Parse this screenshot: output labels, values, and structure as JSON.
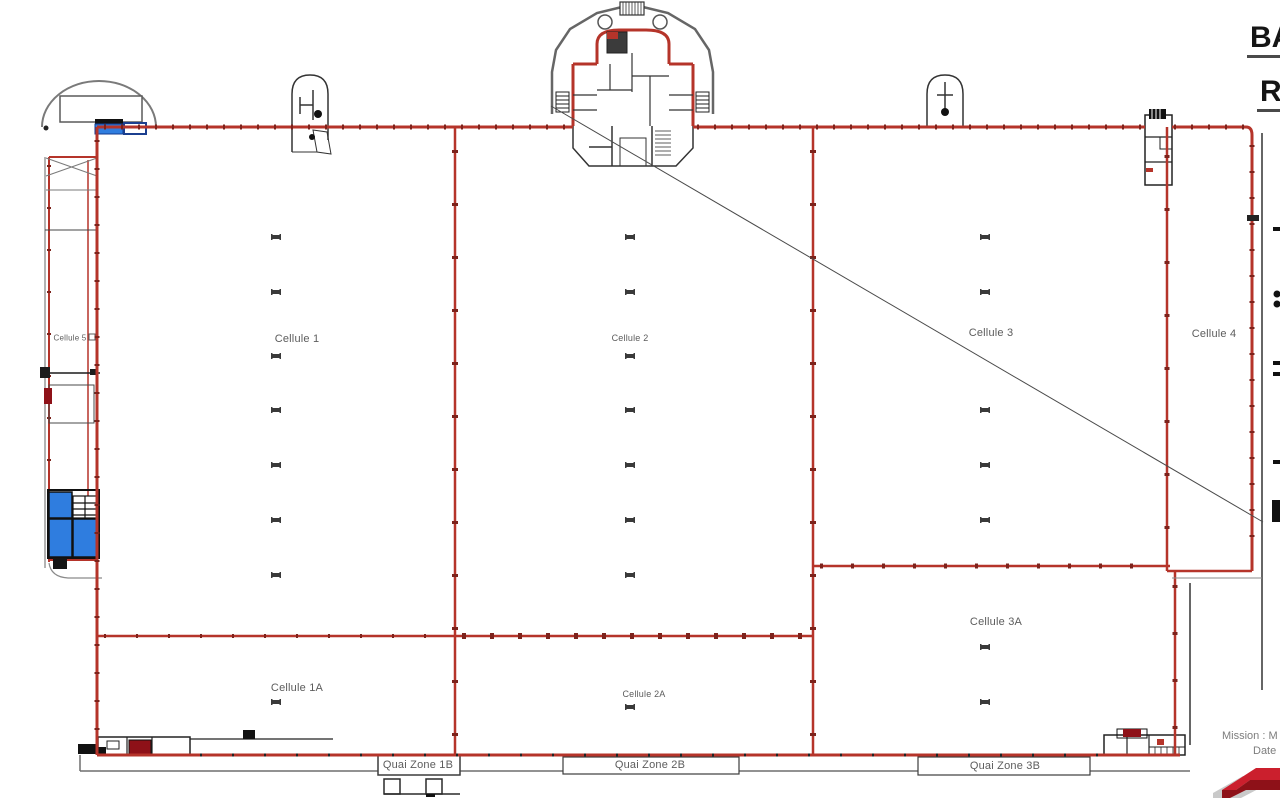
{
  "plan": {
    "title_block": {
      "line1": "BA",
      "line2": "R"
    },
    "cells": [
      {
        "id": "cellule-1",
        "label": "Cellule 1"
      },
      {
        "id": "cellule-2",
        "label": "Cellule 2"
      },
      {
        "id": "cellule-3",
        "label": "Cellule 3"
      },
      {
        "id": "cellule-4",
        "label": "Cellule 4"
      },
      {
        "id": "cellule-5",
        "label": "Cellule 5"
      },
      {
        "id": "cellule-1a",
        "label": "Cellule 1A"
      },
      {
        "id": "cellule-2a",
        "label": "Cellule 2A"
      },
      {
        "id": "cellule-3a",
        "label": "Cellule 3A"
      }
    ],
    "quay_zones": [
      {
        "id": "quai-1b",
        "label": "Quai Zone 1B"
      },
      {
        "id": "quai-2b",
        "label": "Quai Zone 2B"
      },
      {
        "id": "quai-3b",
        "label": "Quai Zone 3B"
      }
    ],
    "footer": {
      "mission_label": "Mission : M",
      "date_label": "Date"
    }
  },
  "colors": {
    "wall_red": "#b5342a",
    "wall_tick": "#7c231c",
    "blue_fill": "#2f7ddf",
    "logo_red": "#cb1f2d",
    "logo_dark_red": "#8e1118",
    "text_gray": "#5c5c5c"
  }
}
